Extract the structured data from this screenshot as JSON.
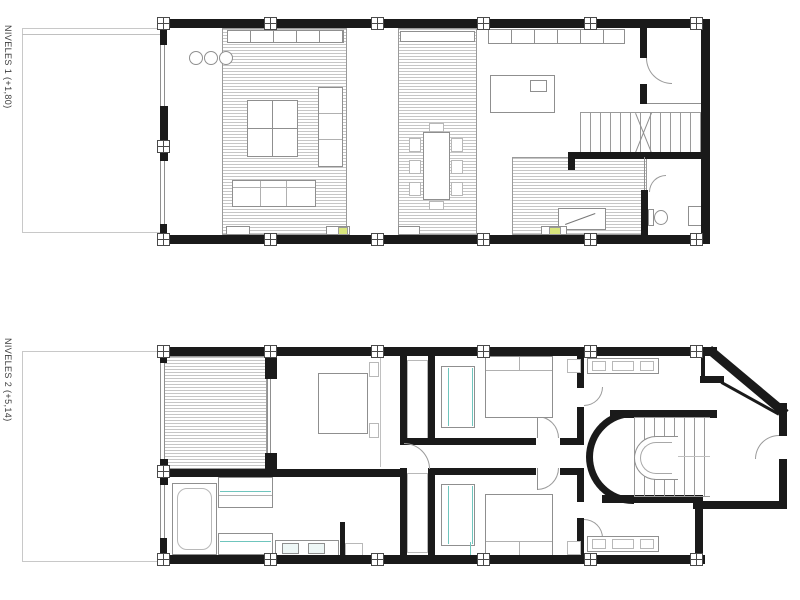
{
  "colors": {
    "wall": "#1a1a1a",
    "line": "#8f8f8f",
    "teal": "#6fc5bd",
    "highlight": "#d9e67d"
  },
  "plans": [
    {
      "id": "level-1",
      "label": "NIVELES 1 (+1,80)"
    },
    {
      "id": "level-2",
      "label": "NIVELES 2 (+5,14)"
    }
  ]
}
